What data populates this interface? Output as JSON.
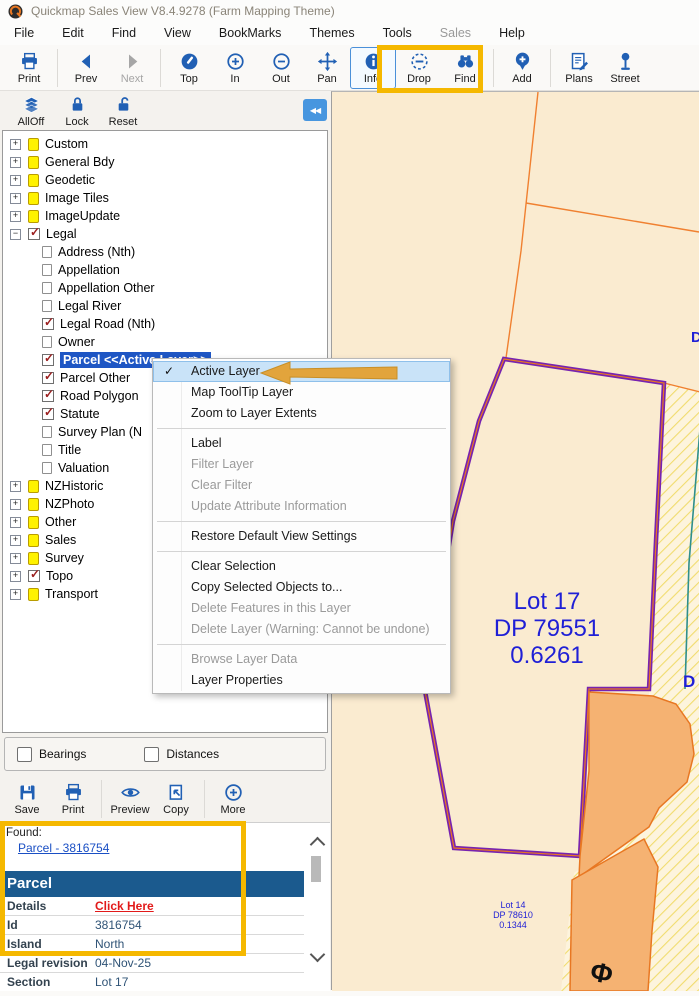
{
  "window": {
    "title": "Quickmap Sales View V8.4.9278 (Farm Mapping Theme)"
  },
  "menu_bar": {
    "items": [
      {
        "label": "File",
        "cls": ""
      },
      {
        "label": "Edit",
        "cls": ""
      },
      {
        "label": "Find",
        "cls": ""
      },
      {
        "label": "View",
        "cls": ""
      },
      {
        "label": "BookMarks",
        "cls": ""
      },
      {
        "label": "Themes",
        "cls": ""
      },
      {
        "label": "Tools",
        "cls": ""
      },
      {
        "label": "Sales",
        "cls": "dis"
      },
      {
        "label": "Help",
        "cls": ""
      }
    ]
  },
  "toolbar_main": {
    "buttons": [
      {
        "label": "Print"
      },
      {
        "label": "Prev"
      },
      {
        "label": "Next"
      },
      {
        "label": "Top"
      },
      {
        "label": "In"
      },
      {
        "label": "Out"
      },
      {
        "label": "Pan"
      },
      {
        "label": "Info"
      },
      {
        "label": "Drop"
      },
      {
        "label": "Find"
      },
      {
        "label": "Add"
      },
      {
        "label": "Plans"
      },
      {
        "label": "Street"
      }
    ]
  },
  "toolbar_layers": {
    "buttons": [
      {
        "label": "AllOff"
      },
      {
        "label": "Lock"
      },
      {
        "label": "Reset"
      }
    ],
    "collapse_label": "◀◀"
  },
  "tree": {
    "items": [
      {
        "label": "Custom",
        "cls": "lv0 exp-plus ic-note"
      },
      {
        "label": "General Bdy",
        "cls": "lv0 exp-plus ic-note"
      },
      {
        "label": "Geodetic",
        "cls": "lv0 exp-plus ic-note"
      },
      {
        "label": "Image Tiles",
        "cls": "lv0 exp-plus ic-note"
      },
      {
        "label": "ImageUpdate",
        "cls": "lv0 exp-plus ic-note"
      },
      {
        "label": "Legal",
        "cls": "lv0 exp-minus ic-check"
      },
      {
        "label": "Address (Nth)",
        "cls": "lv1 ic-blank"
      },
      {
        "label": "Appellation",
        "cls": "lv1 ic-blank"
      },
      {
        "label": "Appellation Other",
        "cls": "lv1 ic-blank"
      },
      {
        "label": "Legal River",
        "cls": "lv1 ic-blank"
      },
      {
        "label": "Legal Road (Nth)",
        "cls": "lv1 ic-check"
      },
      {
        "label": "Owner",
        "cls": "lv1 ic-blank"
      },
      {
        "label": "Parcel <<Active Layer>>",
        "cls": "lv1 ic-check sel"
      },
      {
        "label": "Parcel Other",
        "cls": "lv1 ic-check"
      },
      {
        "label": "Road Polygon",
        "cls": "lv1 ic-check"
      },
      {
        "label": "Statute",
        "cls": "lv1 ic-check"
      },
      {
        "label": "Survey Plan (N",
        "cls": "lv1 ic-blank"
      },
      {
        "label": "Title",
        "cls": "lv1 ic-blank"
      },
      {
        "label": "Valuation",
        "cls": "lv1 ic-blank"
      },
      {
        "label": "NZHistoric",
        "cls": "lv0 exp-plus ic-note"
      },
      {
        "label": "NZPhoto",
        "cls": "lv0 exp-plus ic-note"
      },
      {
        "label": "Other",
        "cls": "lv0 exp-plus ic-note"
      },
      {
        "label": "Sales",
        "cls": "lv0 exp-plus ic-note"
      },
      {
        "label": "Survey",
        "cls": "lv0 exp-plus ic-note"
      },
      {
        "label": "Topo",
        "cls": "lv0 exp-plus ic-check"
      },
      {
        "label": "Transport",
        "cls": "lv0 exp-plus ic-note"
      }
    ]
  },
  "context_menu": {
    "items": [
      {
        "label": "Active Layer",
        "cls": "hl chk"
      },
      {
        "label": "Map ToolTip Layer",
        "cls": ""
      },
      {
        "label": "Zoom to Layer Extents",
        "cls": ""
      },
      {
        "label": "",
        "cls": "sep"
      },
      {
        "label": "Label",
        "cls": ""
      },
      {
        "label": "Filter Layer",
        "cls": "dis"
      },
      {
        "label": "Clear Filter",
        "cls": "dis"
      },
      {
        "label": "Update Attribute Information",
        "cls": "dis"
      },
      {
        "label": "",
        "cls": "sep"
      },
      {
        "label": "Restore Default View Settings",
        "cls": ""
      },
      {
        "label": "",
        "cls": "sep"
      },
      {
        "label": "Clear Selection",
        "cls": ""
      },
      {
        "label": "Copy Selected Objects to...",
        "cls": ""
      },
      {
        "label": "Delete Features in this Layer",
        "cls": "dis"
      },
      {
        "label": "Delete Layer (Warning: Cannot be undone)",
        "cls": "dis"
      },
      {
        "label": "",
        "cls": "sep"
      },
      {
        "label": "Browse Layer Data",
        "cls": "dis"
      },
      {
        "label": "Layer Properties",
        "cls": ""
      }
    ]
  },
  "options_panel": {
    "checkboxes": [
      {
        "label": "Bearings",
        "checked": false
      },
      {
        "label": "Distances",
        "checked": false
      }
    ]
  },
  "toolbar_result": {
    "buttons": [
      {
        "label": "Save"
      },
      {
        "label": "Print"
      },
      {
        "label": "Preview"
      },
      {
        "label": "Copy"
      },
      {
        "label": "More"
      }
    ]
  },
  "found_panel": {
    "found_label": "Found:",
    "link": "Parcel - 3816754",
    "header": "Parcel",
    "rows": [
      {
        "label": "Details",
        "value": "Click Here",
        "cls": "redlink"
      },
      {
        "label": "Id",
        "value": "3816754",
        "cls": ""
      },
      {
        "label": "Island",
        "value": "North",
        "cls": ""
      },
      {
        "label": "Legal revision",
        "value": "04-Nov-25",
        "cls": ""
      },
      {
        "label": "Section",
        "value": "Lot 17",
        "cls": ""
      }
    ]
  },
  "map": {
    "lot17": [
      "Lot 17",
      "DP 79551",
      "0.6261"
    ],
    "lot14": [
      "Lot 14",
      "DP 78610",
      "0.1344"
    ],
    "edge_label_top": "D",
    "edge_label_bottom": "D",
    "road_symbol": "Φ",
    "colors": {
      "background": "#FAEBD0",
      "boundary_orange": "#F08030",
      "parcel_purple": "#7723B0",
      "parcel_orange_fill": "#F5B272",
      "teal_line": "#2F8F8C",
      "label_blue": "#1F1FD6",
      "annotation_yellow": "#F5B800",
      "annotation_arrow": "#E2A43C"
    }
  }
}
